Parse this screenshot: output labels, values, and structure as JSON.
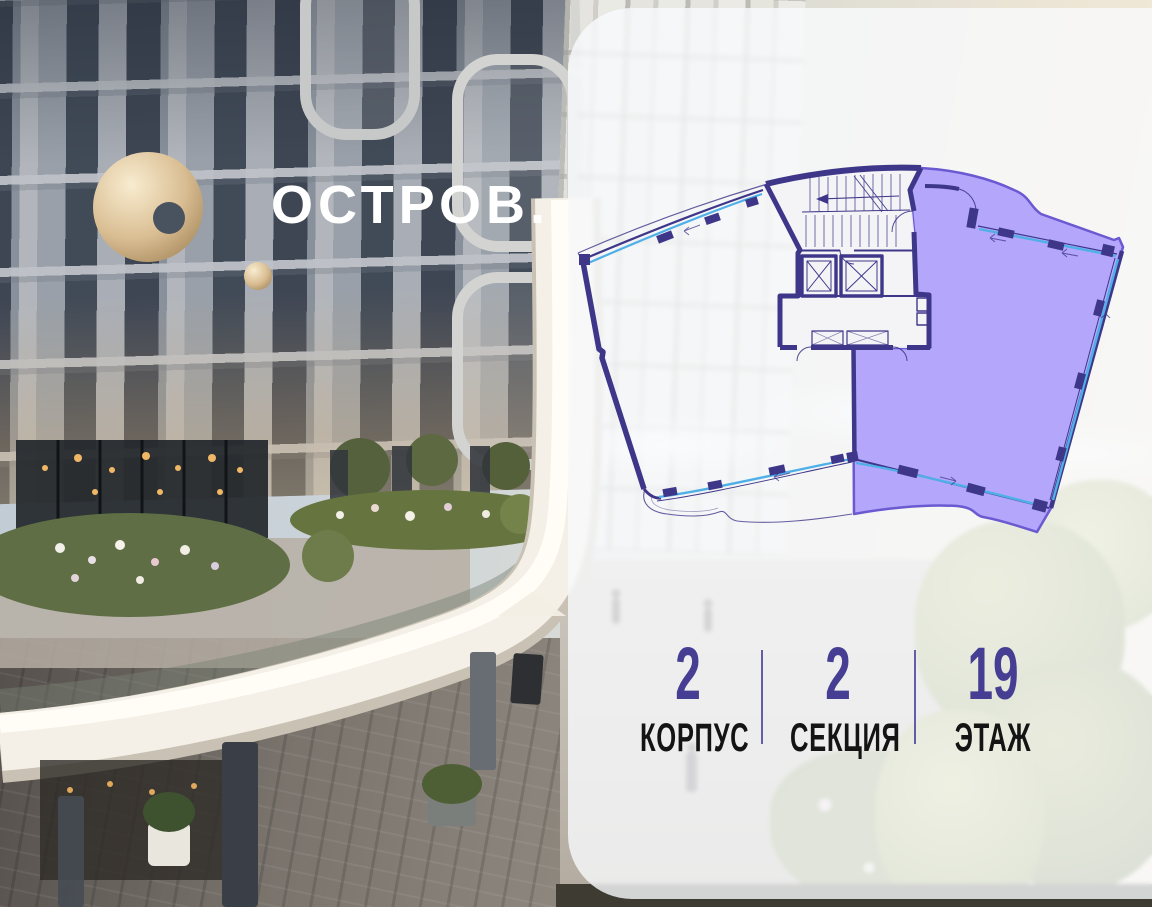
{
  "brand": {
    "name": "ОСТРОВ.",
    "logo_icon": "gold-ring-with-dot"
  },
  "floor_plan": {
    "description": "fan-shaped floor plate with central core, right wing highlighted",
    "highlight_color": "#b3a6fb",
    "highlight_outline_color": "#6a59d1",
    "wall_color": "#3e3789",
    "glazing_color": "#4fb0e8"
  },
  "info": {
    "items": [
      {
        "value": "2",
        "label": "КОРПУС"
      },
      {
        "value": "2",
        "label": "СЕКЦИЯ"
      },
      {
        "value": "19",
        "label": "ЭТАЖ"
      }
    ],
    "value_color": "#453e92",
    "label_color": "#141414",
    "divider_color": "#544c9e"
  }
}
